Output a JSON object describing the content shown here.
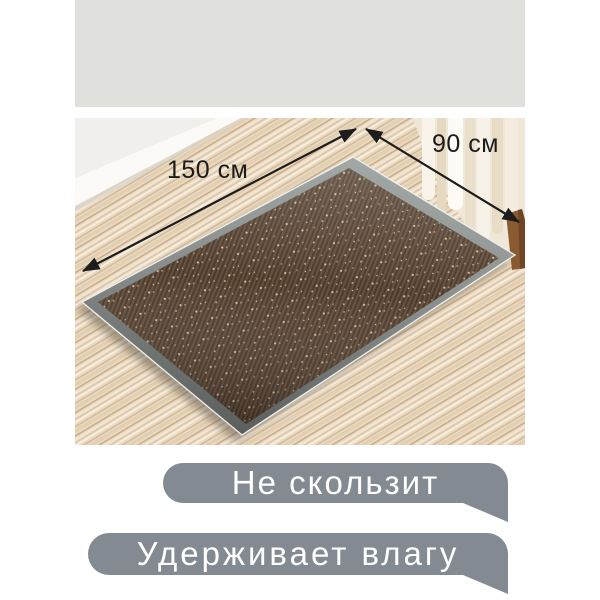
{
  "product_image": {
    "annotations": {
      "length_label": "150 см",
      "width_label": "90 см"
    },
    "scene": "brown ribbed doormat with gray rubber border lying on light wood floor, white wall and baseboard top-left, cream curtains and wooden furniture leg top-right"
  },
  "badges": [
    {
      "label": "Не скользит"
    },
    {
      "label": "Удерживает влагу"
    }
  ],
  "colors": {
    "top_strip": "#e0e1dc",
    "badge_background": "#838a92",
    "badge_text": "#ffffff",
    "annotation_text": "#1b1b1b",
    "arrow": "#1c1c1c",
    "mat_carpet_dark": "#4b3a2c",
    "mat_carpet_light": "#65503d",
    "mat_speckle": "#c8ad8c",
    "mat_border_light": "#a2a8a6",
    "mat_border_dark": "#595d5b",
    "floor_wood": "#ead9c0",
    "wall": "#f1efeb",
    "curtain": "#f7f2e7",
    "furniture_wood": "#8a5a33"
  }
}
